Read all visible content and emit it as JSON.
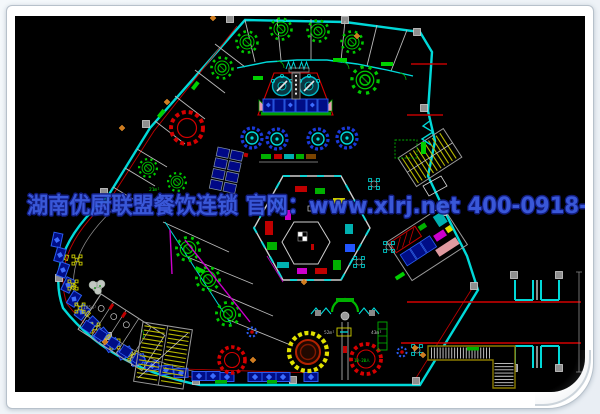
{
  "watermark": {
    "text": "湖南优厨联盟餐饮连锁 官网：www.xlrj.net 400-0918-580",
    "color": "#3d5ce4",
    "outline_color": "#131f86"
  },
  "frame": {
    "background": "#ffffff",
    "border_color": "#b7c1cb",
    "canvas_background": "#000000"
  },
  "palette": {
    "wall_cyan": "#00d9d9",
    "accent_red": "#d40000",
    "table_green": "#00c800",
    "booth_blue_fill": "#000d86",
    "booth_blue_stroke": "#2a5cf0",
    "stair_yellow": "#b8b800",
    "magenta": "#cc00cc",
    "wall_gray": "#b0b0b0",
    "walkway_olive": "#8a7a00"
  },
  "plan": {
    "labels": [
      {
        "text": "21m²",
        "x": 134,
        "y": 175,
        "color": "#00e800",
        "size": 4.5
      },
      {
        "text": "185m²",
        "x": 68,
        "y": 293,
        "color": "#9a9a9a",
        "size": 4.5
      },
      {
        "text": "52m²",
        "x": 309,
        "y": 318,
        "color": "#b9b9b9",
        "size": 4.5
      },
      {
        "text": "43m²",
        "x": 356,
        "y": 318,
        "color": "#b9b9b9",
        "size": 4.5
      },
      {
        "text": "10-20人",
        "x": 339,
        "y": 346,
        "color": "#00e800",
        "size": 4
      }
    ]
  }
}
